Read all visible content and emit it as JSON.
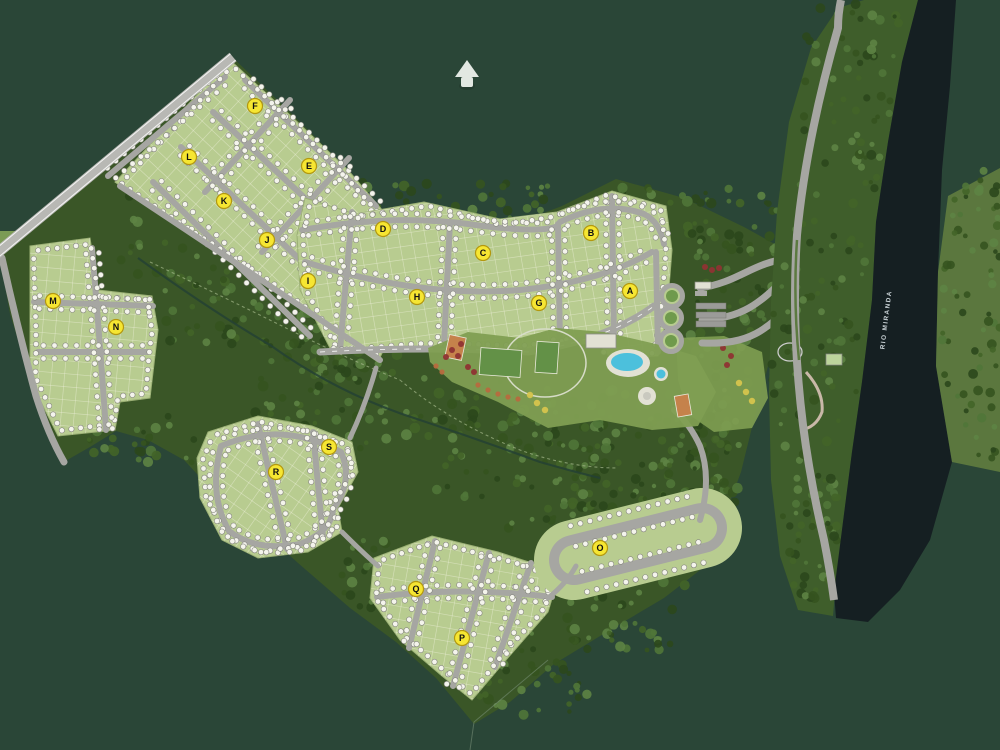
{
  "map": {
    "title": "residential-masterplan-aerial",
    "north_arrow_icon": "north-arrow-icon",
    "river_label": "RIO MIRANDA",
    "block_markers": [
      {
        "label": "A",
        "x": 630,
        "y": 291
      },
      {
        "label": "B",
        "x": 591,
        "y": 233
      },
      {
        "label": "C",
        "x": 483,
        "y": 253
      },
      {
        "label": "D",
        "x": 383,
        "y": 229
      },
      {
        "label": "E",
        "x": 309,
        "y": 166
      },
      {
        "label": "F",
        "x": 255,
        "y": 106
      },
      {
        "label": "G",
        "x": 539,
        "y": 303
      },
      {
        "label": "H",
        "x": 417,
        "y": 297
      },
      {
        "label": "I",
        "x": 308,
        "y": 281
      },
      {
        "label": "J",
        "x": 267,
        "y": 240
      },
      {
        "label": "K",
        "x": 224,
        "y": 201
      },
      {
        "label": "L",
        "x": 189,
        "y": 157
      },
      {
        "label": "M",
        "x": 53,
        "y": 301
      },
      {
        "label": "N",
        "x": 116,
        "y": 327
      },
      {
        "label": "O",
        "x": 600,
        "y": 548
      },
      {
        "label": "P",
        "x": 462,
        "y": 638
      },
      {
        "label": "Q",
        "x": 416,
        "y": 589
      },
      {
        "label": "R",
        "x": 276,
        "y": 472
      },
      {
        "label": "S",
        "x": 329,
        "y": 447
      }
    ],
    "colors": {
      "background": "#2a4637",
      "forest_base": "#3a5627",
      "tree_shades": [
        "#2b471c",
        "#35531f",
        "#436428",
        "#507539",
        "#5d8344"
      ],
      "block_green": "#b8cc90",
      "block_grid": "#eef0da",
      "road": "#a6a6a2",
      "road_edge": "#ffffff",
      "highway": "#b8b8b4",
      "water": "#151f22",
      "east_bank": "#5b773e",
      "riverside_land": "#3f5e2b",
      "lawn": "#7f9e52",
      "marker_fill": "#f6e632",
      "marker_ring": "#b3980f",
      "marker_text": "#111111",
      "lot_dot": "#f4f4ec",
      "lot_dot_ring": "#85857f",
      "pool": "#4cc0dc",
      "court_orange": "#c5824b",
      "court_green": "#639147",
      "deck": "#e2e1d4",
      "flower_red": "#8f3333",
      "flower_orange": "#b76a3e",
      "flower_yellow": "#d6c44d",
      "trail": "#a3b789",
      "creek": "#244134",
      "median_green": "#5c7a40",
      "boundary_line": "#7c947c",
      "clearing": "#7b9b55",
      "north_arrow": "#e2e8e2",
      "river_text": "#c9d2d6"
    }
  }
}
